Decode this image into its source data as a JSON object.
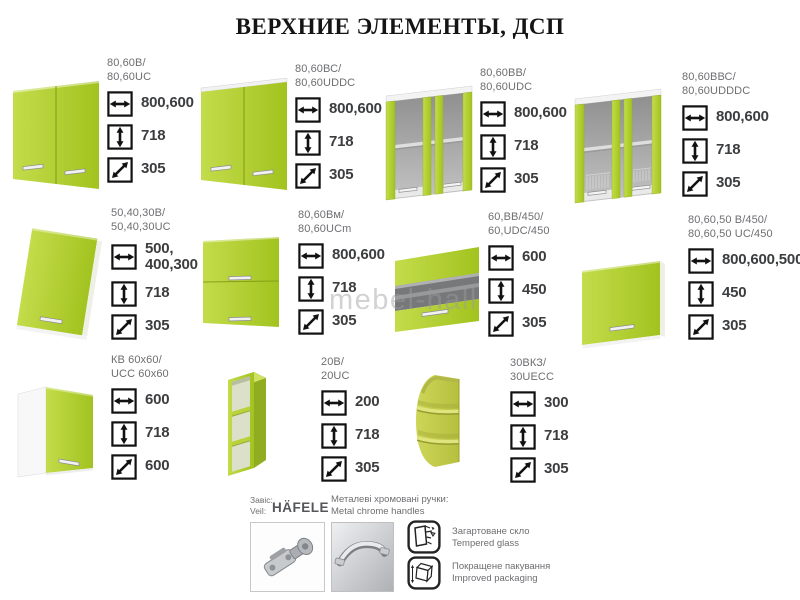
{
  "title": "ВЕРХНИЕ ЭЛЕМЕНТЫ, ДСП",
  "watermark": "mebel-hall",
  "colors": {
    "accent_green": "#aecb2c",
    "accent_olive": "#c6cc52",
    "glass_gray": "#76787a",
    "label_gray": "#6d6e71",
    "value_dark": "#3c3d3f"
  },
  "cabinets": [
    {
      "code1": "80,60В/",
      "code2": "80,60UC",
      "width": "800,600",
      "height": "718",
      "depth": "305"
    },
    {
      "code1": "80,60ВС/",
      "code2": "80,60UDDC",
      "width": "800,600",
      "height": "718",
      "depth": "305"
    },
    {
      "code1": "80,60ВВ/",
      "code2": "80,60UDC",
      "width": "800,600",
      "height": "718",
      "depth": "305"
    },
    {
      "code1": "80,60ВВС/",
      "code2": "80,60UDDDC",
      "width": "800,600",
      "height": "718",
      "depth": "305"
    },
    {
      "code1": "50,40,30В/",
      "code2": "50,40,30UC",
      "width": "500, 400,300",
      "height": "718",
      "depth": "305"
    },
    {
      "code1": "80,60Вм/",
      "code2": "80,60UCm",
      "width": "800,600",
      "height": "718",
      "depth": "305"
    },
    {
      "code1": "60,ВВ/450/",
      "code2": "60,UDC/450",
      "width": "600",
      "height": "450",
      "depth": "305"
    },
    {
      "code1": "80,60,50 В/450/",
      "code2": "80,60,50 UC/450",
      "width": "800,600,500",
      "height": "450",
      "depth": "305"
    },
    {
      "code1": "КВ 60х60/",
      "code2": "UCC 60х60",
      "width": "600",
      "height": "718",
      "depth": "600"
    },
    {
      "code1": "20В/",
      "code2": "20UC",
      "width": "200",
      "height": "718",
      "depth": "305"
    },
    {
      "code1": "30ВКЗ/",
      "code2": "30UECC",
      "width": "300",
      "height": "718",
      "depth": "305"
    }
  ],
  "legend": {
    "hinge_ua": "Завіс:",
    "hinge_en": "Veil:",
    "brand": "HÄFELE",
    "handles_ua": "Металеві хромовані ручки:",
    "handles_en": "Metal chrome handles",
    "glass_ua": "Загартоване скло",
    "glass_en": "Tempered glass",
    "pack_ua": "Покращене пакування",
    "pack_en": "Improved packaging"
  }
}
